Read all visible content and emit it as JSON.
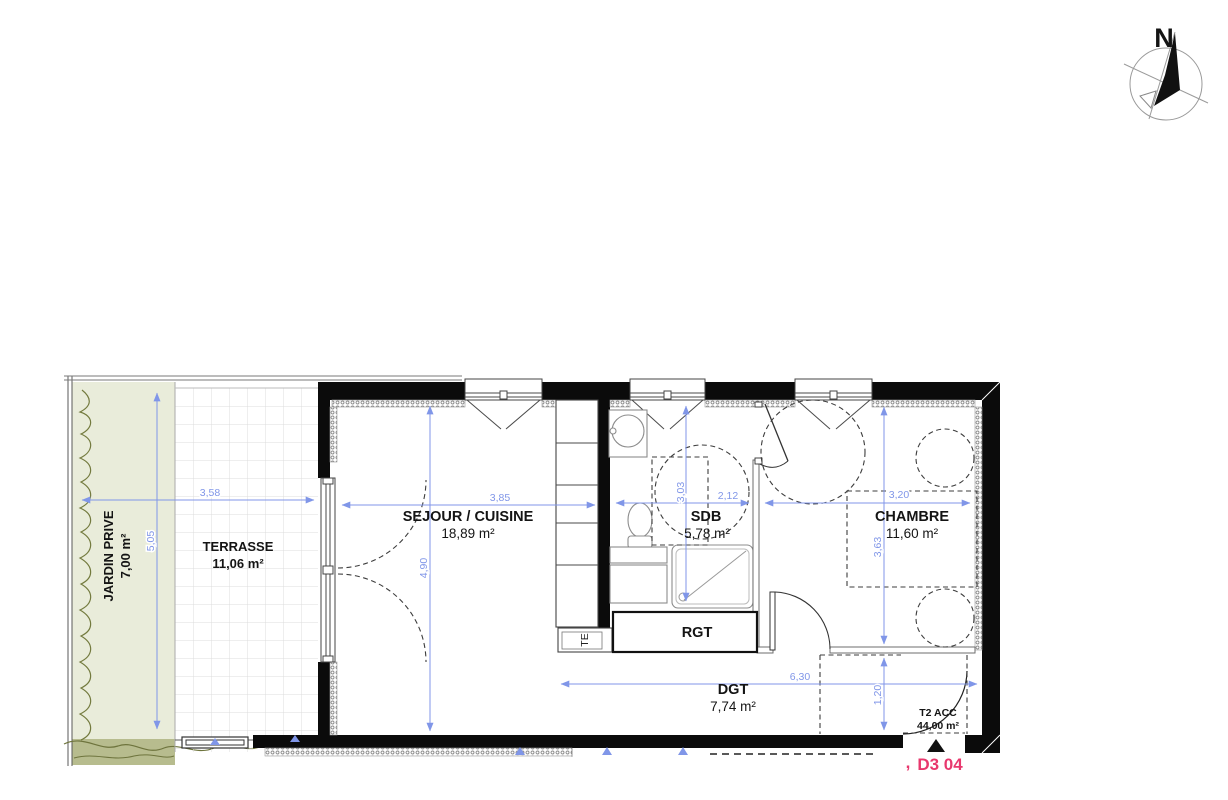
{
  "compass": {
    "north": "N"
  },
  "rooms": {
    "jardin": {
      "name": "JARDIN PRIVE",
      "area": "7,00 m²"
    },
    "terrasse": {
      "name": "TERRASSE",
      "area": "11,06 m²"
    },
    "sejour": {
      "name": "SEJOUR / CUISINE",
      "area": "18,89 m²"
    },
    "sdb": {
      "name": "SDB",
      "area": "5,78 m²"
    },
    "chambre": {
      "name": "CHAMBRE",
      "area": "11,60 m²"
    },
    "rgt": {
      "name": "RGT"
    },
    "dgt": {
      "name": "DGT",
      "area": "7,74 m²"
    }
  },
  "dims": {
    "d358": "3,58",
    "d505": "5,05",
    "d385": "3,85",
    "d490": "4,90",
    "d303": "3,03",
    "d212": "2,12",
    "d320": "3,20",
    "d363": "3,63",
    "d630": "6,30",
    "d120": "1,20"
  },
  "unit": {
    "type": "T2 ACC",
    "area": "44,00 m²",
    "lot": "D3 04",
    "mark": ","
  },
  "labels": {
    "te": "TE"
  },
  "colors": {
    "dimension_blue": "#8096e8",
    "lot_pink": "#e8386e",
    "wall_black": "#0b0b0b",
    "jardin_green": "#e9ecda",
    "hedge_olive": "#b7bc8e"
  }
}
